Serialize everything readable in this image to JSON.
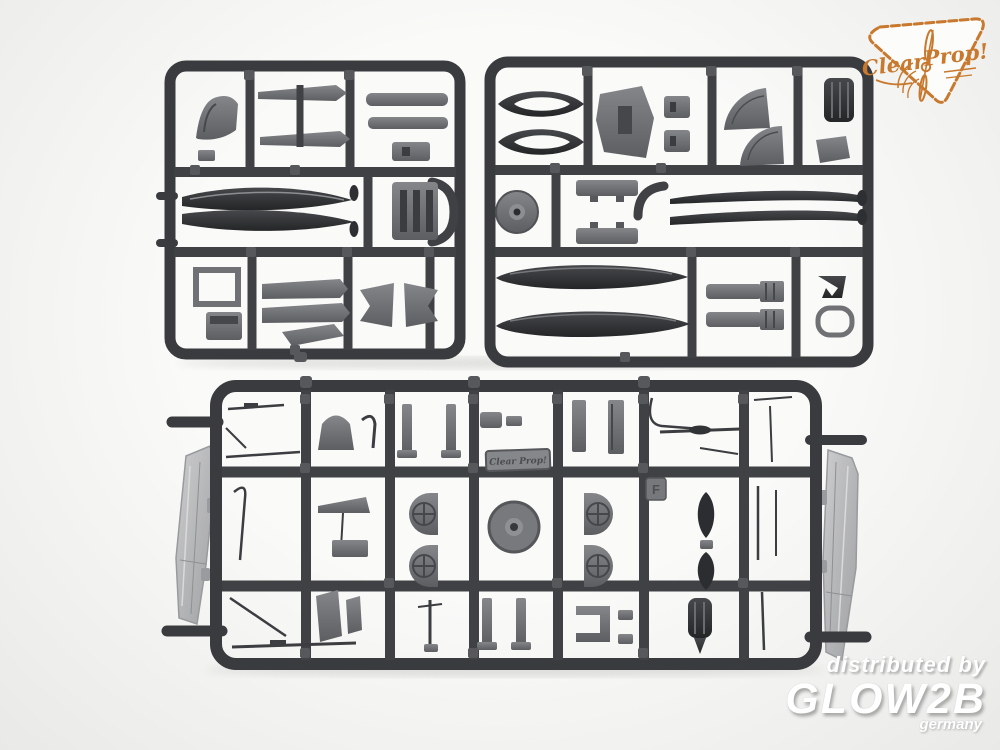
{
  "canvas": {
    "background": "#f2f2f0"
  },
  "branding": {
    "logo": {
      "word1": "Clear",
      "word2": "Prop!",
      "color": "#c8792e"
    }
  },
  "sprue": {
    "plastic_color": "#3a3b3e",
    "part_face_color": "#6f7174",
    "clear_part_color": "#b8b9bb",
    "nameplate_text": "Clear Prop!",
    "gate_letter": "F"
  },
  "watermark": {
    "line1": "distributed by",
    "line2": "GLOW2B",
    "line3": "germany",
    "color": "#ffffff"
  }
}
